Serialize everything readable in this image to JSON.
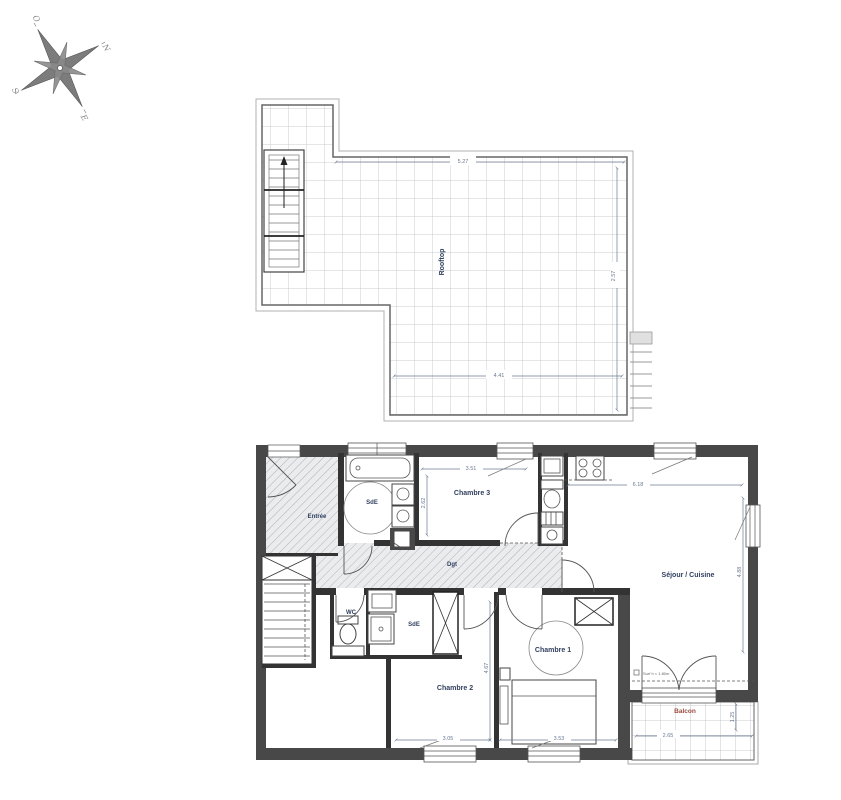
{
  "compass": {
    "letters": {
      "o": "O",
      "n": "N",
      "s": "S",
      "e": "E"
    }
  },
  "terrace": {
    "label": "Rooftop",
    "dims": {
      "top": "5.27",
      "right": "2.57",
      "bottom": "4.41"
    }
  },
  "apartment": {
    "labels": {
      "entree": "Entrée",
      "sde1": "SdE",
      "chambre3": "Chambre 3",
      "sejour": "Séjour / Cuisine",
      "dgt": "Dgt",
      "wc": "WC",
      "sde2": "SdE",
      "chambre1": "Chambre 1",
      "chambre2": "Chambre 2",
      "balcon": "Balcon"
    },
    "dims": {
      "chambre3_w": "3.51",
      "chambre3_h": "2.62",
      "sejour_w": "6.18",
      "sejour_h": "4.88",
      "chambre2_h": "4.67",
      "chambre2_w": "3.05",
      "chambre1_w": "3.53",
      "balcon_w": "2.65",
      "balcon_h": "1.25"
    },
    "note": "Surf h < 1.80m"
  },
  "colors": {
    "wall": "#484848",
    "room_label": "#31405f",
    "dim_label": "#6b7a92",
    "balcon_label": "#9c4a3c"
  }
}
